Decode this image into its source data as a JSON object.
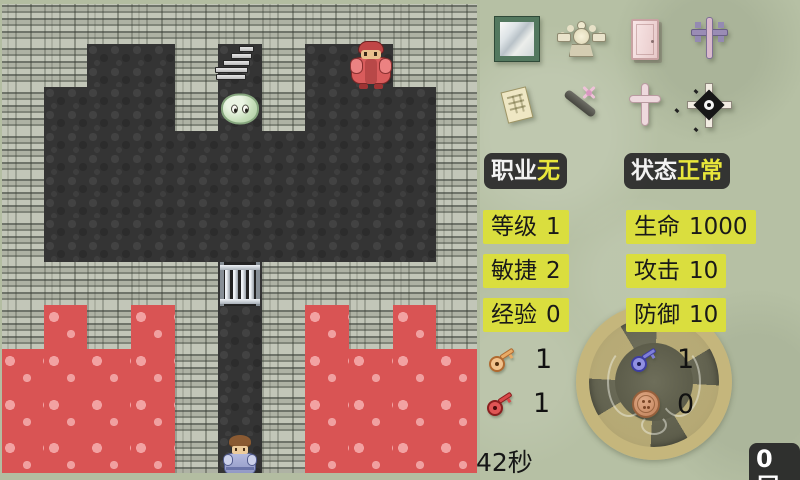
{
  "map": {
    "rows": [
      "LLLLLLLLLLL",
      "LLDDLSLDELL",
      "LDDDLMLDDDL",
      "LDDDDDDDDDL",
      "LDDDDDDDDDL",
      "LDDDDDDDDDL",
      "LLLLLGLLLLL",
      "LVLVLDLVLVL",
      "VVVVLDLVVVV",
      "VVVVLDLVVVV",
      "VVVVLHLVVVV"
    ],
    "legend": {
      "L": "light-floor",
      "D": "dark-floor",
      "V": "lava",
      "S": "stairs-up",
      "M": "slime-monster",
      "E": "red-guard-monster",
      "G": "iron-gate",
      "H": "player-hero"
    },
    "colors": {
      "light_floor": "#9aa092",
      "dark_floor": "#343434",
      "lava": "#d95454",
      "edge_green": "#b3bda1"
    }
  },
  "panel": {
    "colors": {
      "panel_bg": "#b6c0a4",
      "badge_dark": "#2c2c2c",
      "badge_yellow": "#dade3e",
      "value_yellow": "#e9e73b"
    },
    "items": [
      "mirror",
      "winged-medal",
      "door",
      "purple-cross",
      "scroll",
      "pickaxe",
      "pink-cross",
      "compass-star"
    ],
    "job": {
      "label": "职业",
      "value": "无"
    },
    "status": {
      "label": "状态",
      "value": "正常"
    },
    "stats": [
      {
        "id": "level",
        "label": "等级",
        "value": "1"
      },
      {
        "id": "hp",
        "label": "生命",
        "value": "1000"
      },
      {
        "id": "agility",
        "label": "敏捷",
        "value": "2"
      },
      {
        "id": "attack",
        "label": "攻击",
        "value": "10"
      },
      {
        "id": "exp",
        "label": "经验",
        "value": "0"
      },
      {
        "id": "defense",
        "label": "防御",
        "value": "10"
      }
    ],
    "inventory": [
      {
        "icon": "yellow-key",
        "count": "1"
      },
      {
        "icon": "blue-key",
        "count": "1"
      },
      {
        "icon": "red-key",
        "count": "1"
      },
      {
        "icon": "coin",
        "count": "0"
      }
    ],
    "timer": "42秒",
    "floor": "0层"
  }
}
